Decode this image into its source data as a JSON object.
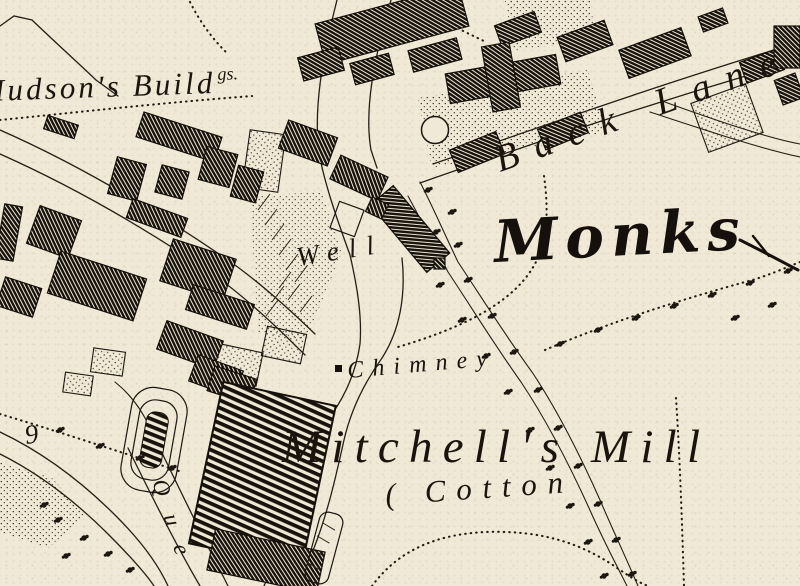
{
  "map": {
    "description": "historic-ordnance-survey-style-town-map",
    "colors": {
      "paper": "#f0e9d7",
      "ink": "#1a140d"
    },
    "labels": {
      "hudsons_buildings_main": "Hudson's Build",
      "hudsons_buildings_sup": "gs.",
      "back_lane": "Back Lane",
      "monks": "Monks",
      "well": "Well",
      "chimney": "Chimney",
      "mitchells_mill": "Mitchell's Mill",
      "cotton": "( Cotton",
      "que_street": "Que",
      "parcel_number": "9"
    }
  }
}
